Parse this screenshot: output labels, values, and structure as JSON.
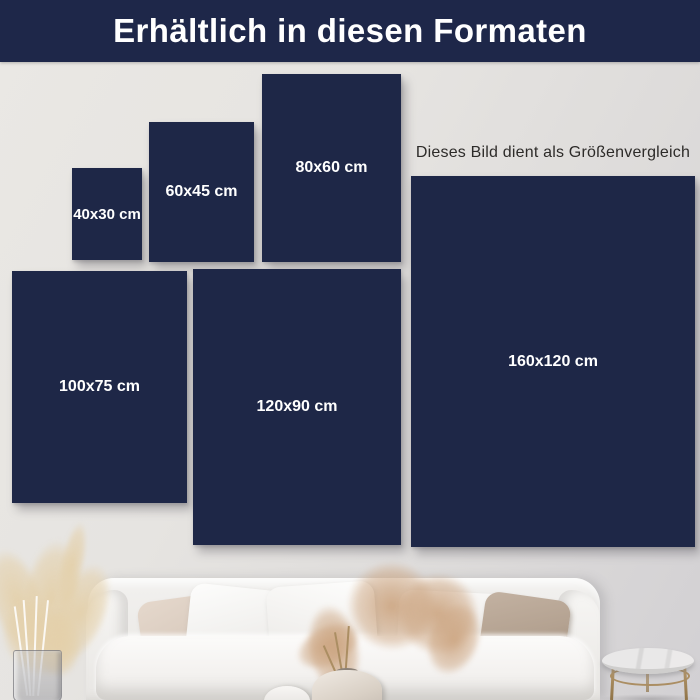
{
  "header": {
    "title": "Erhältlich in diesen Formaten"
  },
  "note": {
    "text": "Dieses Bild dient als Größenvergleich"
  },
  "panels": [
    {
      "id": "40x30",
      "label": "40x30 cm"
    },
    {
      "id": "60x45",
      "label": "60x45 cm"
    },
    {
      "id": "80x60",
      "label": "80x60 cm"
    },
    {
      "id": "100x75",
      "label": "100x75 cm"
    },
    {
      "id": "120x90",
      "label": "120x90 cm"
    },
    {
      "id": "160x120",
      "label": "160x120 cm"
    }
  ],
  "colors": {
    "header_bg": "#1e2749",
    "panel": "#1e2747",
    "label_text": "#ffffff",
    "note_text": "#2d2b29",
    "wall_light": "#eae8e4",
    "wall_dark": "#d2d0d3",
    "sofa_white": "#f6f5f3",
    "pillow_blush": "#e5d8cc",
    "pillow_taupe": "#b4a291",
    "pampas_cream": "#e4d2ae",
    "pampas_rust": "#cda784",
    "brass": "#ab8e63",
    "marble": "#e6e5e4"
  }
}
